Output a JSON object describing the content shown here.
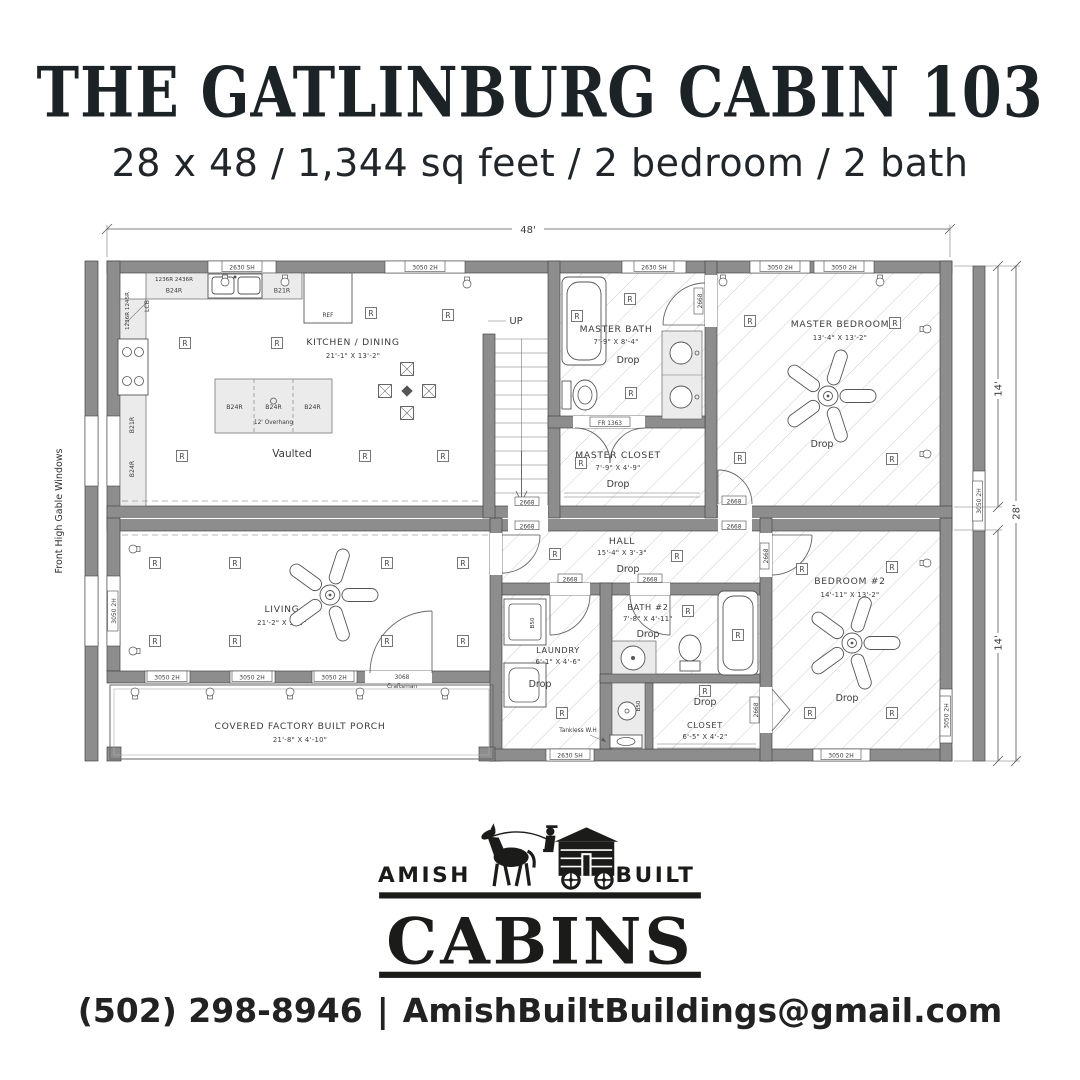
{
  "header": {
    "title": "THE GATLINBURG CABIN 103",
    "subtitle": "28 x 48 / 1,344 sq feet / 2 bedroom / 2 bath"
  },
  "plan": {
    "dims": {
      "width": "48'",
      "upper": "14'",
      "lower": "14'",
      "total": "28'"
    },
    "side_note": "Front High Gable Windows",
    "rooms": {
      "kitchen": {
        "name": "KITCHEN / DINING",
        "size": "21'-1\" X 13'-2\""
      },
      "master_bath": {
        "name": "MASTER BATH",
        "size": "7'-9\" X 8'-4\""
      },
      "master_closet": {
        "name": "MASTER CLOSET",
        "size": "7'-9\" X 4'-9\""
      },
      "master_bedroom": {
        "name": "MASTER BEDROOM",
        "size": "13'-4\" X 13'-2\""
      },
      "living": {
        "name": "LIVING",
        "size": "21'-2\" X 9'-4\""
      },
      "hall": {
        "name": "HALL",
        "size": "15'-4\" X 3'-3\""
      },
      "laundry": {
        "name": "LAUNDRY",
        "size": "6'-1\" X 4'-6\""
      },
      "bath2": {
        "name": "BATH #2",
        "size": "7'-8\" X 4'-11\""
      },
      "closet": {
        "name": "CLOSET",
        "size": "6'-5\" X 4'-2\""
      },
      "bedroom2": {
        "name": "BEDROOM #2",
        "size": "14'-11\" X 13'-2\""
      },
      "porch": {
        "name": "COVERED FACTORY BUILT PORCH",
        "size": "21'-8\" X 4'-10\""
      }
    },
    "labels": {
      "up": "UP",
      "ref": "REF",
      "vaulted": "Vaulted",
      "drop": "Drop",
      "recessed": "R",
      "win_3050": "3050 2H",
      "win_2630": "2630 SH",
      "door_2668": "2668",
      "door_fr": "FR 1363",
      "door_entry_1": "3068",
      "door_entry_2": "Craftsman",
      "cab_b24": "B24R",
      "cab_b21": "B21R",
      "cab_b50": "B50",
      "cab_lcb": "LCB",
      "cab_wall_a": "1236R 2436R",
      "cab_wall_b": "1236R 1245R",
      "island_overhang": "12' Overhang",
      "tankless": "Tankless W.H"
    }
  },
  "logo": {
    "amish": "AMISH",
    "built": "BUILT",
    "cabins": "CABINS"
  },
  "footer": {
    "phone": "(502) 298-8946",
    "sep": "|",
    "email": "AmishBuiltBuildings@gmail.com"
  }
}
